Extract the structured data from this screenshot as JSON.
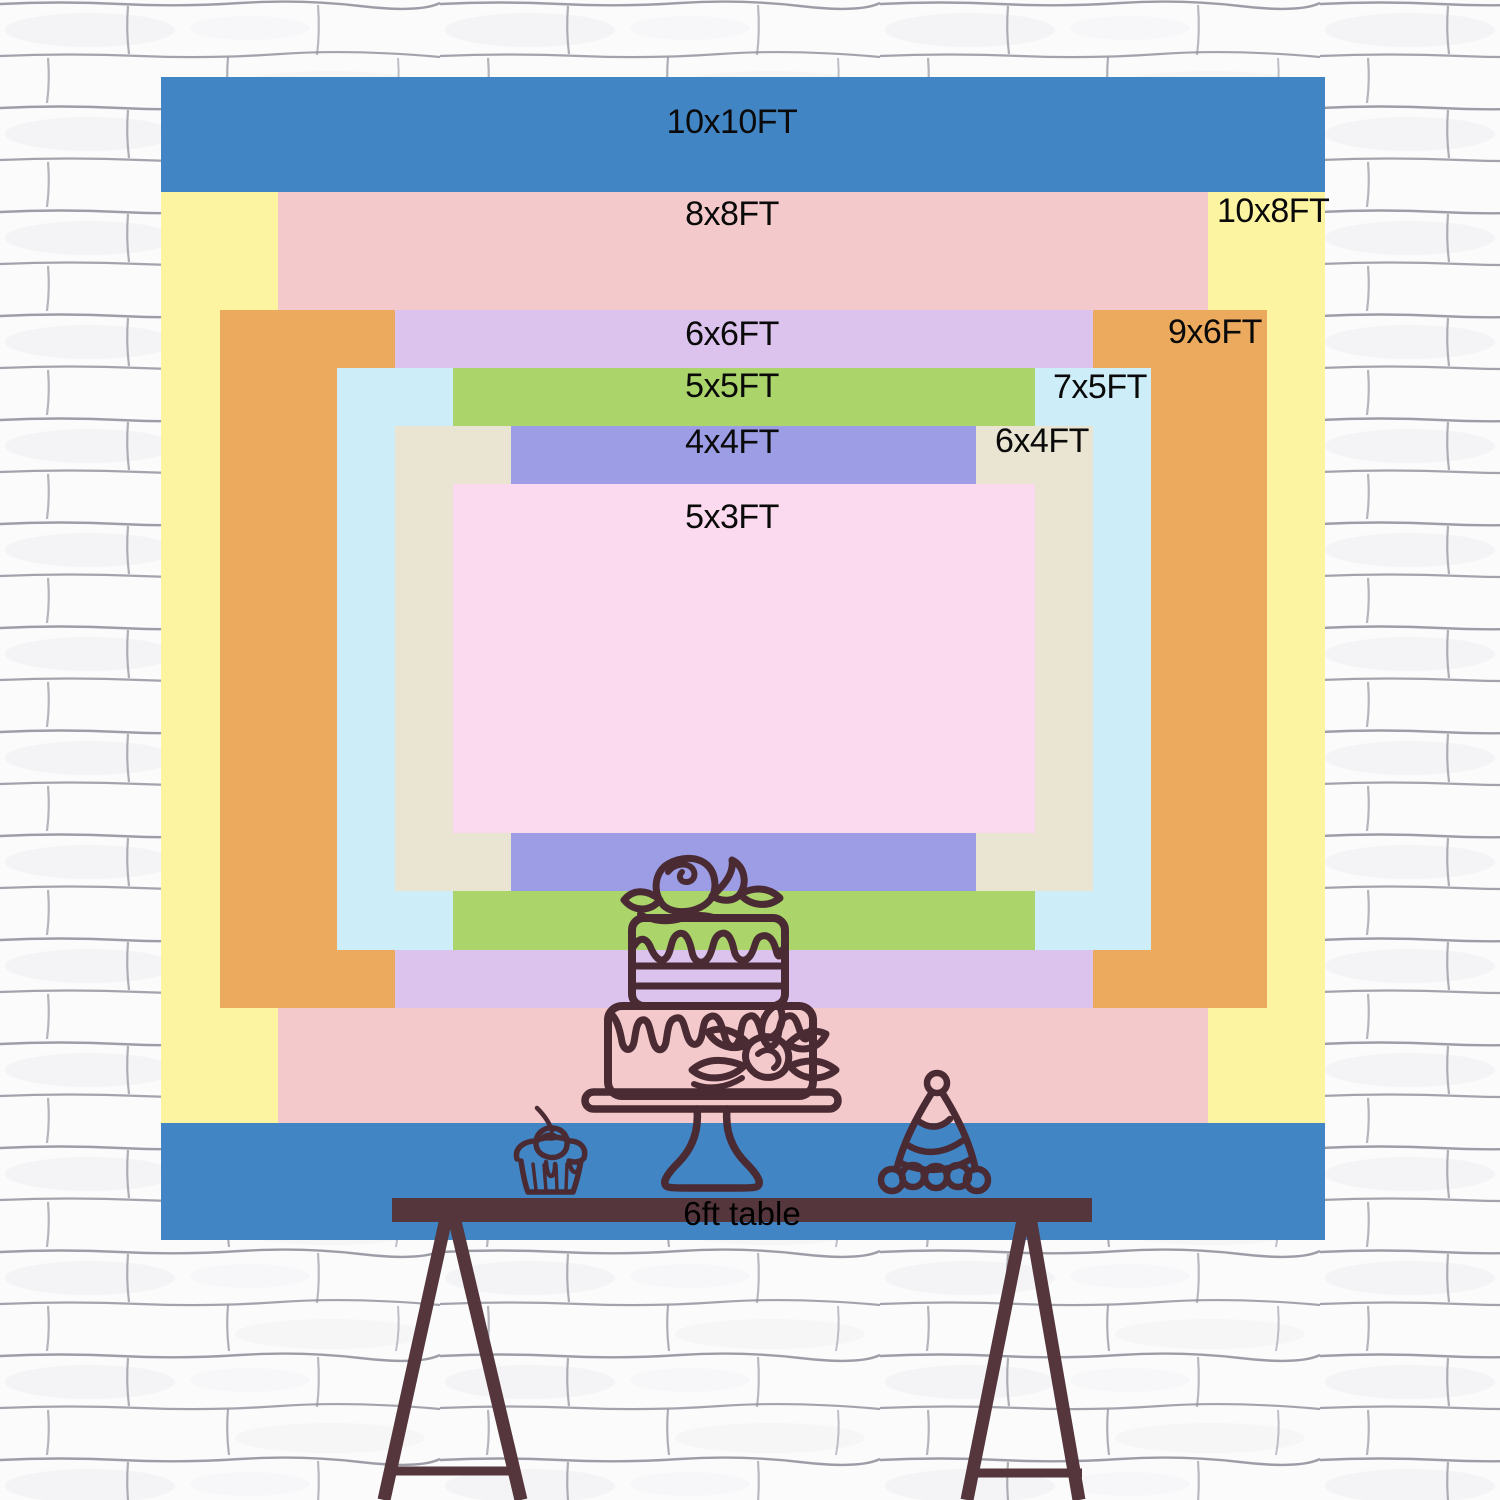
{
  "poster": {
    "label_color": "#0a0a0a",
    "line_art_color": "#4A2B33",
    "sizes": [
      {
        "label": "10x10FT",
        "color": "#4285C5",
        "rect": {
          "x": 161,
          "y": 77,
          "w": 1164,
          "h": 1163
        },
        "label_align": "center",
        "label_x": 732,
        "label_y": 105
      },
      {
        "label": "10x8FT",
        "color": "#FCF4A1",
        "rect": {
          "x": 161,
          "y": 192,
          "w": 1164,
          "h": 931
        },
        "label_align": "left",
        "label_x": 1217,
        "label_y": 194
      },
      {
        "label": "8x8FT",
        "color": "#F4C9CB",
        "rect": {
          "x": 278,
          "y": 192,
          "w": 930,
          "h": 931
        },
        "label_align": "center",
        "label_x": 732,
        "label_y": 197
      },
      {
        "label": "9x6FT",
        "color": "#EBAA5D",
        "rect": {
          "x": 220,
          "y": 310,
          "w": 1047,
          "h": 698
        },
        "label_align": "left",
        "label_x": 1168,
        "label_y": 315
      },
      {
        "label": "6x6FT",
        "color": "#DBC3EE",
        "rect": {
          "x": 395,
          "y": 310,
          "w": 698,
          "h": 698
        },
        "label_align": "center",
        "label_x": 732,
        "label_y": 317
      },
      {
        "label": "7x5FT",
        "color": "#CDEEF8",
        "rect": {
          "x": 337,
          "y": 368,
          "w": 814,
          "h": 582
        },
        "label_align": "left",
        "label_x": 1053,
        "label_y": 370
      },
      {
        "label": "5x5FT",
        "color": "#ABD56B",
        "rect": {
          "x": 453,
          "y": 368,
          "w": 582,
          "h": 582
        },
        "label_align": "center",
        "label_x": 732,
        "label_y": 369
      },
      {
        "label": "6x4FT",
        "color": "#EAE5D3",
        "rect": {
          "x": 395,
          "y": 426,
          "w": 698,
          "h": 465
        },
        "label_align": "left",
        "label_x": 995,
        "label_y": 424
      },
      {
        "label": "4x4FT",
        "color": "#9C9DE5",
        "rect": {
          "x": 511,
          "y": 426,
          "w": 465,
          "h": 465
        },
        "label_align": "center",
        "label_x": 732,
        "label_y": 425
      },
      {
        "label": "5x3FT",
        "color": "#FBD9EE",
        "rect": {
          "x": 453,
          "y": 484,
          "w": 582,
          "h": 349
        },
        "label_align": "center",
        "label_x": 732,
        "label_y": 500
      }
    ],
    "table": {
      "label": "6ft table",
      "color": "#54363C"
    },
    "wall": {
      "background": "#FBFBFC",
      "mortar_line_color": "#8D8D98"
    },
    "icons": [
      "birthday-cake-icon",
      "cake-stand-icon",
      "cupcake-icon",
      "cherry-icon",
      "party-hat-icon",
      "table-legs-icon",
      "brick-wall-background"
    ]
  }
}
